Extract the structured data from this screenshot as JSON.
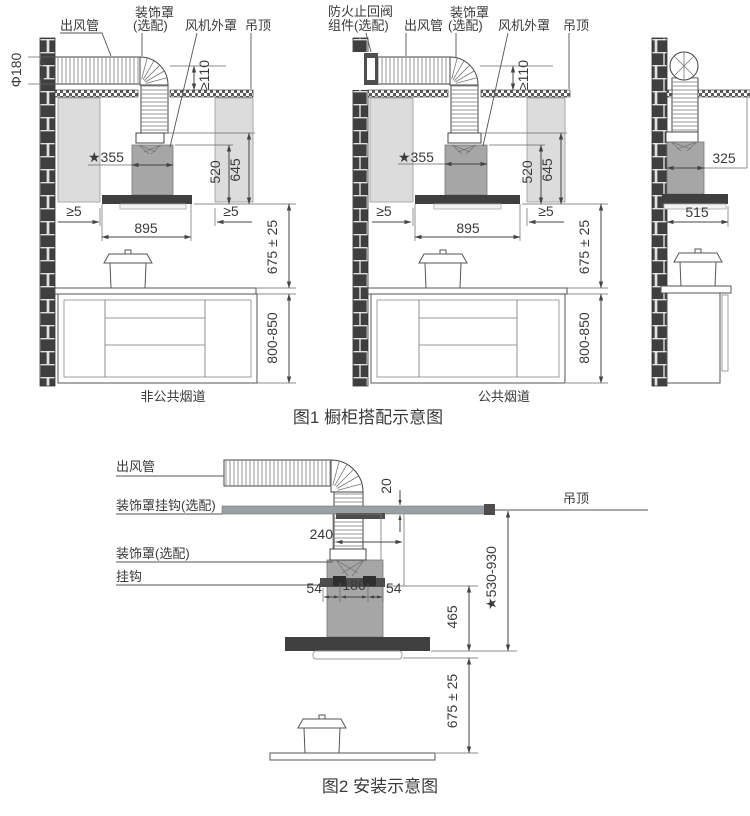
{
  "figure1": {
    "caption": "图1 橱柜搭配示意图",
    "left": {
      "caption": "非公共烟道",
      "labels": {
        "outlet_pipe": "出风管",
        "deco_cover_line1": "装饰罩",
        "deco_cover_line2": "(选配)",
        "fan_outer_cover": "风机外罩",
        "ceiling": "吊顶"
      },
      "dims": {
        "pipe_diameter": "Φ180",
        "min_110": "≥110",
        "star_355": "★355",
        "h_520": "520",
        "h_645": "645",
        "gap_left": "≥5",
        "gap_right": "≥5",
        "w_895": "895",
        "h_675": "675 ± 25",
        "h_800_850": "800-850"
      }
    },
    "middle": {
      "caption": "公共烟道",
      "labels": {
        "fire_valve_line1": "防火止回阀",
        "fire_valve_line2": "组件(选配)",
        "outlet_pipe": "出风管",
        "deco_cover_line1": "装饰罩",
        "deco_cover_line2": "(选配)",
        "fan_outer_cover": "风机外罩",
        "ceiling": "吊顶"
      },
      "dims": {
        "min_110": "≥110",
        "star_355": "★355",
        "h_520": "520",
        "h_645": "645",
        "gap_left": "≥5",
        "gap_right": "≥5",
        "w_895": "895",
        "h_675": "675 ± 25",
        "h_800_850": "800-850"
      }
    },
    "right": {
      "dims": {
        "w_325": "325",
        "w_515": "515"
      }
    }
  },
  "figure2": {
    "caption": "图2 安装示意图",
    "labels": {
      "outlet_pipe": "出风管",
      "deco_cover_hook": "装饰罩挂钩(选配)",
      "deco_cover": "装饰罩(选配)",
      "hook": "挂钩",
      "ceiling": "吊顶"
    },
    "dims": {
      "d_20": "20",
      "d_240": "240",
      "d_54_left": "54",
      "d_186": "186",
      "d_54_right": "54",
      "d_465": "465",
      "d_530_930": "★530-930",
      "d_675": "675 ± 25"
    }
  }
}
